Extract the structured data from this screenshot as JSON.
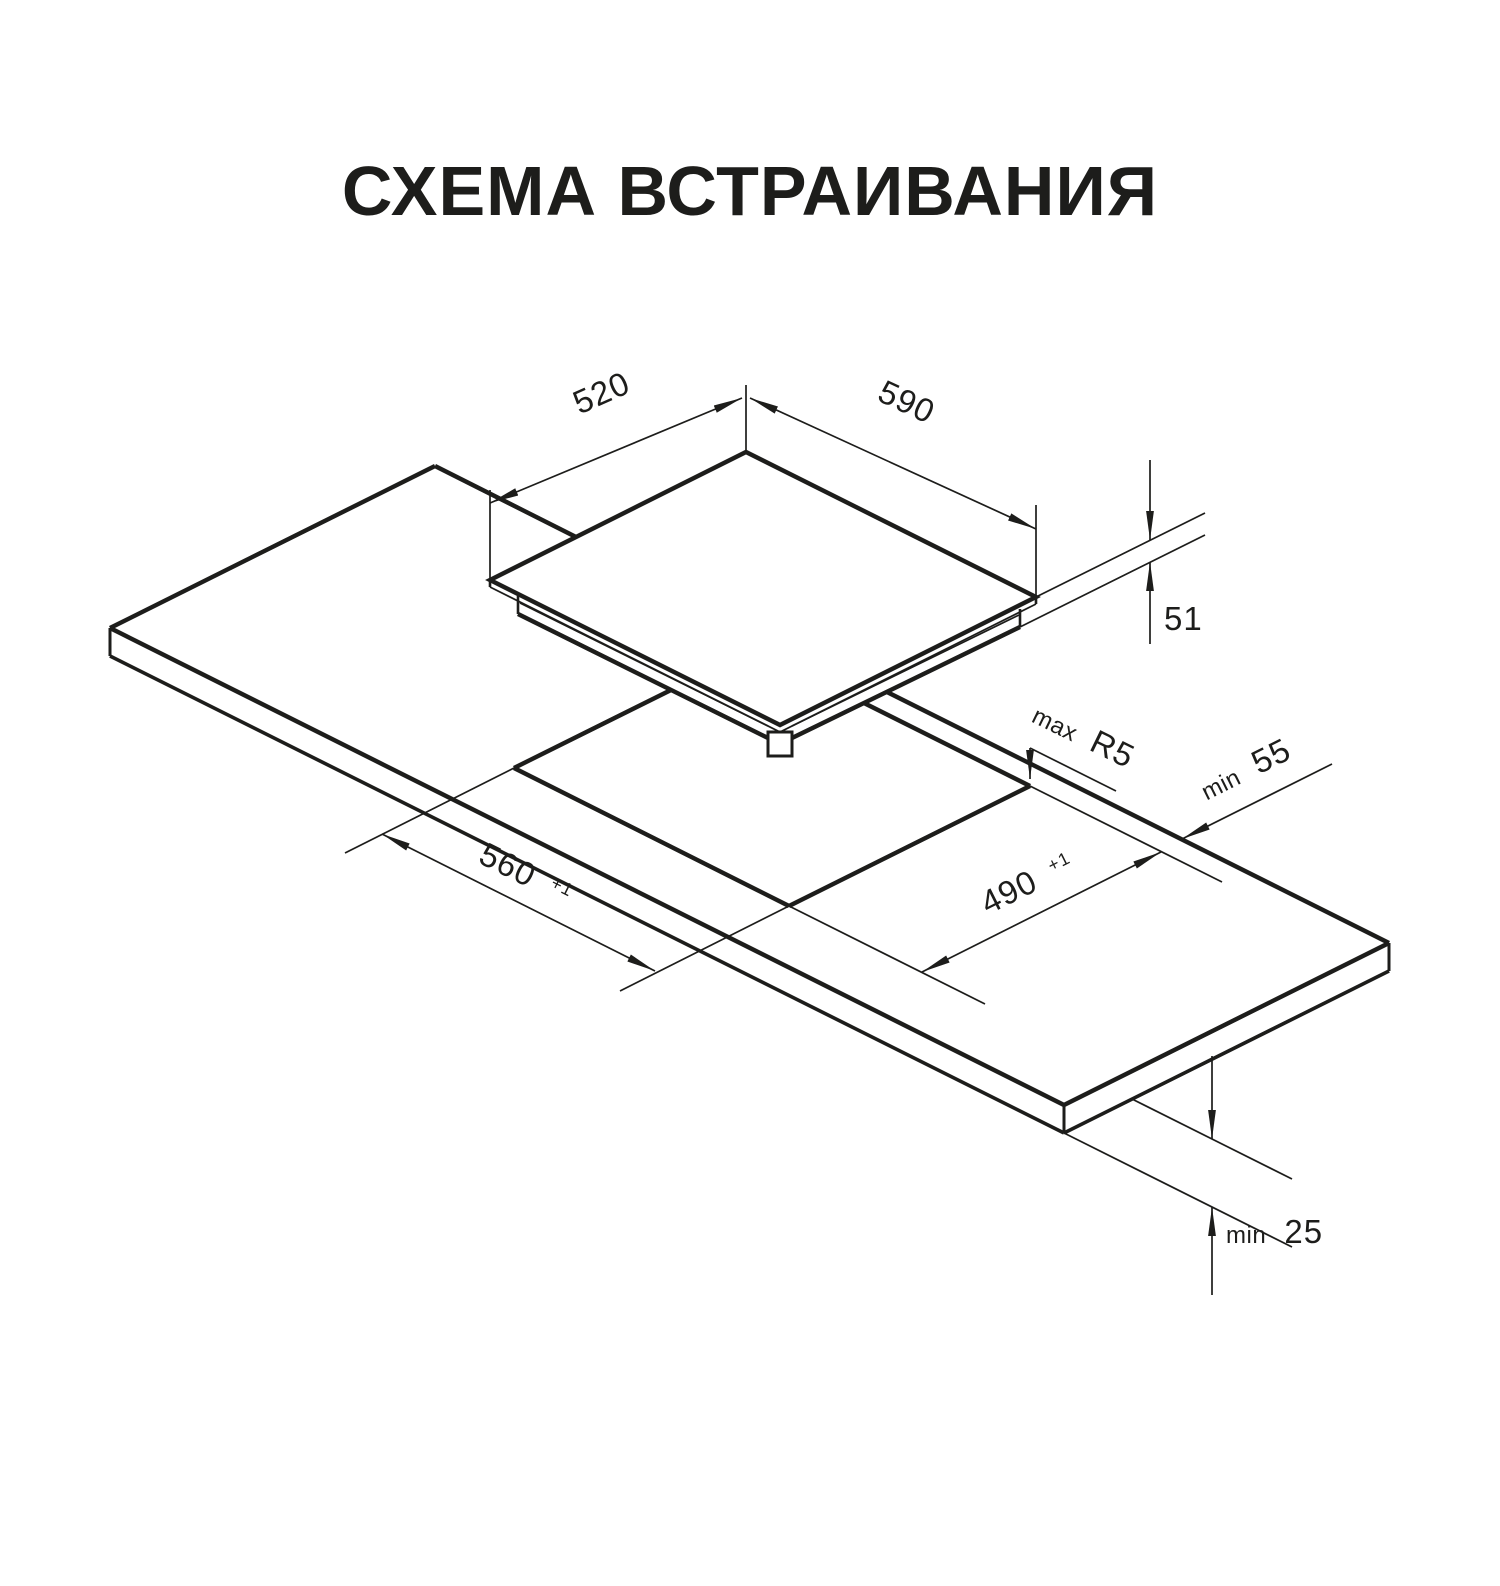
{
  "title": "СХЕМА ВСТРАИВАНИЯ",
  "drawing": {
    "colors": {
      "ink": "#1d1d1b",
      "background": "#ffffff"
    },
    "labels": {
      "hob_side_depth": "520",
      "hob_front_width": "590",
      "hob_height": "51",
      "cutout_corner_radius": {
        "prefix": "max",
        "value": "R5"
      },
      "rear_edge_clearance": {
        "prefix": "min",
        "value": "55"
      },
      "cutout_length": {
        "value": "560",
        "tolerance": "+1"
      },
      "cutout_depth": {
        "value": "490",
        "tolerance": "+1"
      },
      "worktop_thickness": {
        "prefix": "min",
        "value": "25"
      }
    }
  }
}
